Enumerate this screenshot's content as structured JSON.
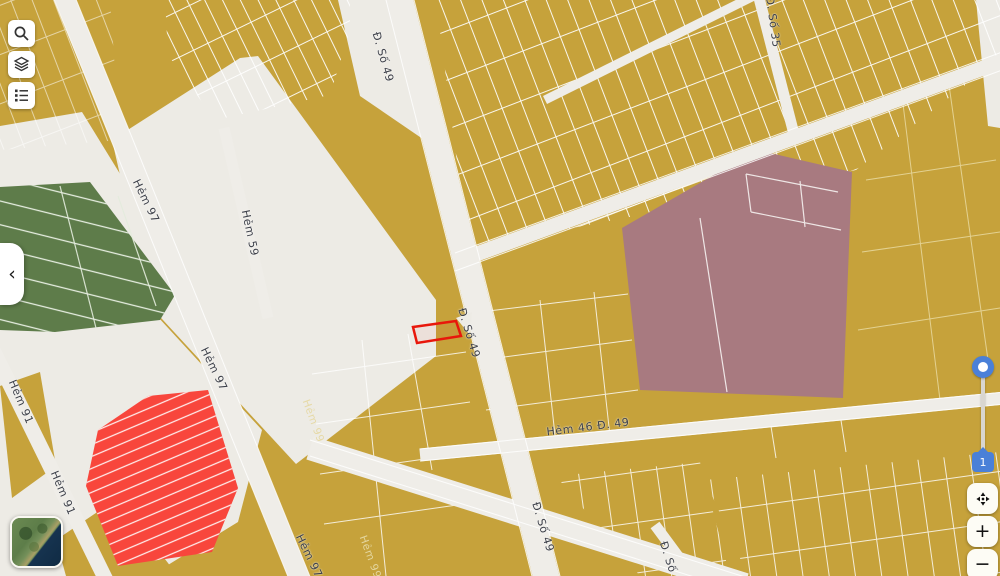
{
  "map": {
    "colors": {
      "base_parcel": "#c6a23b",
      "open_area": "#edebe5",
      "road": "#efede8",
      "green_parcel": "#5e7c4a",
      "red_parcel": "#f8463c",
      "mauve_parcel": "#a87a80",
      "parcel_line": "#ffffff",
      "selection": "#e8170b"
    },
    "labels": [
      {
        "text": "Đ. Số 49"
      },
      {
        "text": "Đ. Số 49"
      },
      {
        "text": "Đ. Số 49"
      },
      {
        "text": "Hẻm 97"
      },
      {
        "text": "Hẻm 97"
      },
      {
        "text": "Hẻm 97"
      },
      {
        "text": "Hẻm 59"
      },
      {
        "text": "Hẻm 91"
      },
      {
        "text": "Hẻm 91"
      },
      {
        "text": "Hẻm 99"
      },
      {
        "text": "Hẻm 99"
      },
      {
        "text": "Hẻm 46 Đ. 49"
      },
      {
        "text": "Đ. Số 35"
      },
      {
        "text": "Đ. Số"
      }
    ]
  },
  "controls": {
    "collapse_chevron": "‹",
    "slider": {
      "value": "1"
    },
    "zoom_in": "+",
    "zoom_out": "−"
  }
}
